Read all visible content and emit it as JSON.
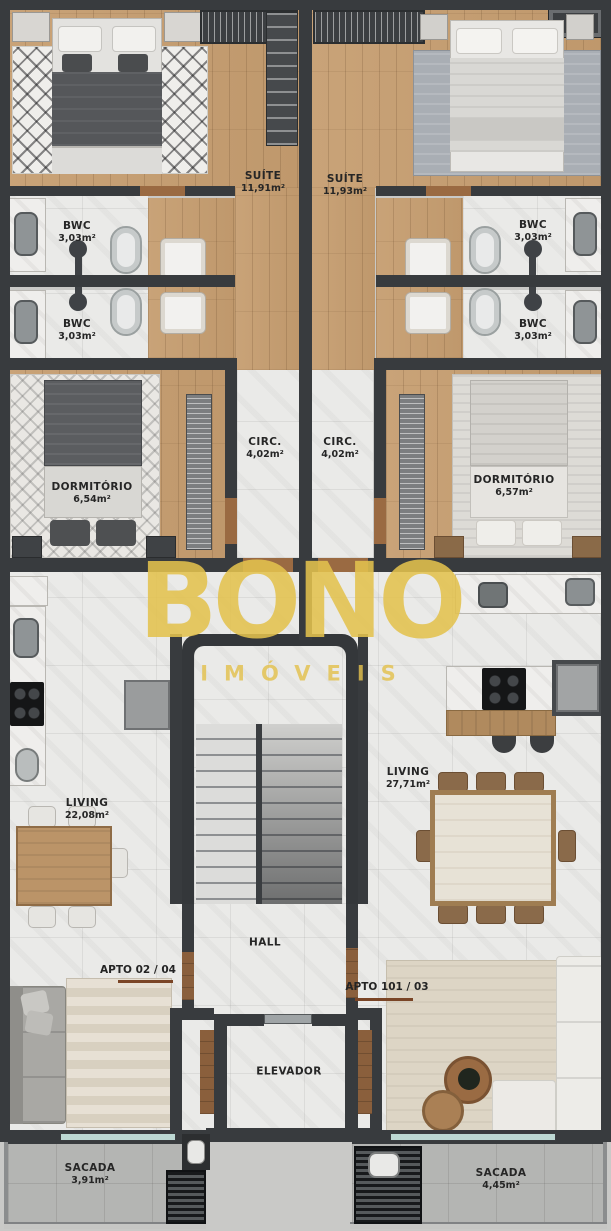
{
  "watermark": {
    "brand": "BONO",
    "tagline": "IMÓVEIS",
    "color": "#E3C14D"
  },
  "units": [
    {
      "label": "APTO 02 / 04"
    },
    {
      "label": "APTO 101 / 03"
    }
  ],
  "rooms": [
    {
      "name": "SUÍTE",
      "area": "11,91m²"
    },
    {
      "name": "SUÍTE",
      "area": "11,93m²"
    },
    {
      "name": "BWC",
      "area": "3,03m²"
    },
    {
      "name": "BWC",
      "area": "3,03m²"
    },
    {
      "name": "BWC",
      "area": "3,03m²"
    },
    {
      "name": "BWC",
      "area": "3,03m²"
    },
    {
      "name": "DORMITÓRIO",
      "area": "6,54m²"
    },
    {
      "name": "DORMITÓRIO",
      "area": "6,57m²"
    },
    {
      "name": "CIRC.",
      "area": "4,02m²"
    },
    {
      "name": "CIRC.",
      "area": "4,02m²"
    },
    {
      "name": "LIVING",
      "area": "22,08m²"
    },
    {
      "name": "LIVING",
      "area": "27,71m²"
    },
    {
      "name": "HALL",
      "area": ""
    },
    {
      "name": "ELEVADOR",
      "area": ""
    },
    {
      "name": "SACADA",
      "area": "3,91m²"
    },
    {
      "name": "SACADA",
      "area": "4,45m²"
    }
  ],
  "colors": {
    "wall": "#383B3E",
    "wood": "#C5A075",
    "marble": "#E9E9E7",
    "concrete": "#B5B6B4",
    "watermark_gold": "#E3C14D",
    "underline_brown": "#7A4526"
  }
}
